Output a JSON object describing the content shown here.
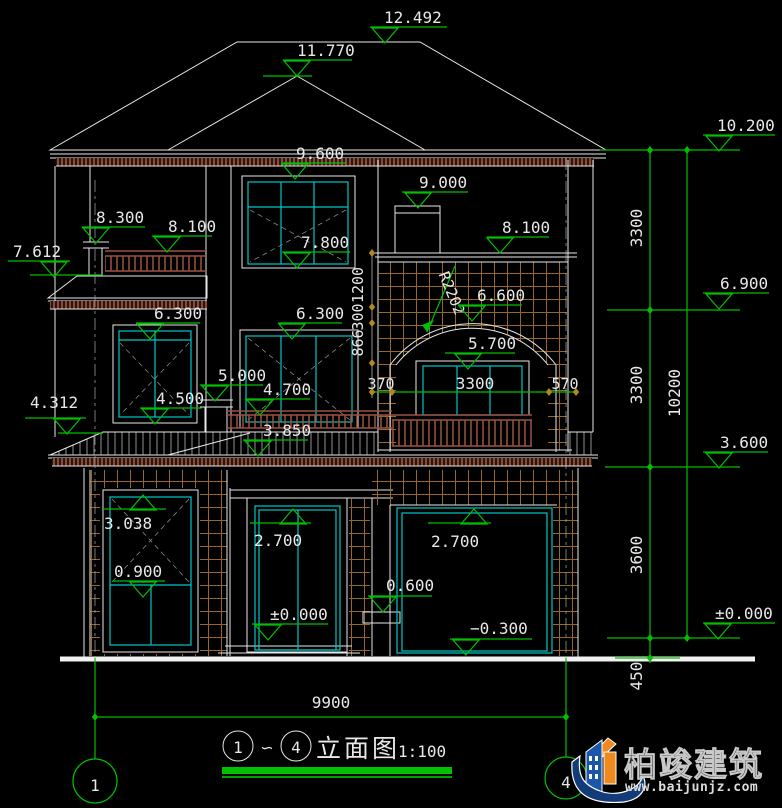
{
  "markers": [
    {
      "name": "ridge-top",
      "value": "12.492"
    },
    {
      "name": "front-hip-peak",
      "value": "11.770"
    },
    {
      "name": "main-eave",
      "value": "9.600"
    },
    {
      "name": "chimney-top",
      "value": "9.000"
    },
    {
      "name": "roof-level-right",
      "value": "10.200"
    },
    {
      "name": "balcony-post-cap",
      "value": "8.300"
    },
    {
      "name": "balcony-rail-left",
      "value": "8.100"
    },
    {
      "name": "canopy-left-top",
      "value": "7.612"
    },
    {
      "name": "tower-cornice",
      "value": "8.100"
    },
    {
      "name": "window-2f-large-sill",
      "value": "7.800"
    },
    {
      "name": "window-2f-left-head",
      "value": "6.300"
    },
    {
      "name": "window-2f-mid-head",
      "value": "6.300"
    },
    {
      "name": "arch-top",
      "value": "6.600"
    },
    {
      "name": "level-2f-right",
      "value": "6.900"
    },
    {
      "name": "arch-window-head",
      "value": "5.700"
    },
    {
      "name": "rail-post-2f-cap",
      "value": "5.000"
    },
    {
      "name": "window-2f-mid-sill",
      "value": "4.700"
    },
    {
      "name": "window-2f-left-sill",
      "value": "4.500"
    },
    {
      "name": "canopy-lower-left",
      "value": "4.312"
    },
    {
      "name": "balcony-2f-floor",
      "value": "3.850"
    },
    {
      "name": "level-1f-roof-right",
      "value": "3.600"
    },
    {
      "name": "window-1f-head",
      "value": "3.038"
    },
    {
      "name": "window-1f-sill",
      "value": "0.900"
    },
    {
      "name": "entry-door-head",
      "value": "2.700"
    },
    {
      "name": "porch-step",
      "value": "0.600"
    },
    {
      "name": "garage-door-head",
      "value": "2.700"
    },
    {
      "name": "entry-floor-level",
      "value": "±0.000"
    },
    {
      "name": "garage-floor-level",
      "value": "−0.300"
    },
    {
      "name": "ground-level-right",
      "value": "±0.000"
    }
  ],
  "dims": [
    {
      "name": "floor-height-3f",
      "value": "3300"
    },
    {
      "name": "floor-height-2f",
      "value": "3300"
    },
    {
      "name": "total-height",
      "value": "10200"
    },
    {
      "name": "floor-height-1f",
      "value": "3600"
    },
    {
      "name": "plinth-height",
      "value": "450"
    },
    {
      "name": "total-width",
      "value": "9900"
    },
    {
      "name": "band-1200",
      "value": "1200"
    },
    {
      "name": "band-300",
      "value": "300"
    },
    {
      "name": "band-866",
      "value": "866"
    },
    {
      "name": "arch-jamb-left",
      "value": "370"
    },
    {
      "name": "arch-window-width",
      "value": "3300"
    },
    {
      "name": "arch-jamb-right",
      "value": "570"
    }
  ],
  "radius_label": "R2202",
  "title_block": {
    "axis_start": "1",
    "tilde": "∽",
    "axis_end": "4",
    "title": "立面图",
    "scale": "1:100"
  },
  "axis_bubbles": {
    "left": "1",
    "right": "4"
  },
  "logo": {
    "company": "柏竣建筑",
    "website": "www.baijunjz.com"
  },
  "colors": {
    "dim_green": "#00c000",
    "window_cyan": "#00c8c8",
    "line_white": "#e8e8e8",
    "brick": "#96682c",
    "railing": "#9a5242",
    "tile_band": "#8a4a38",
    "logo_blue": "#1a57a8",
    "logo_orange": "#f0891e"
  }
}
